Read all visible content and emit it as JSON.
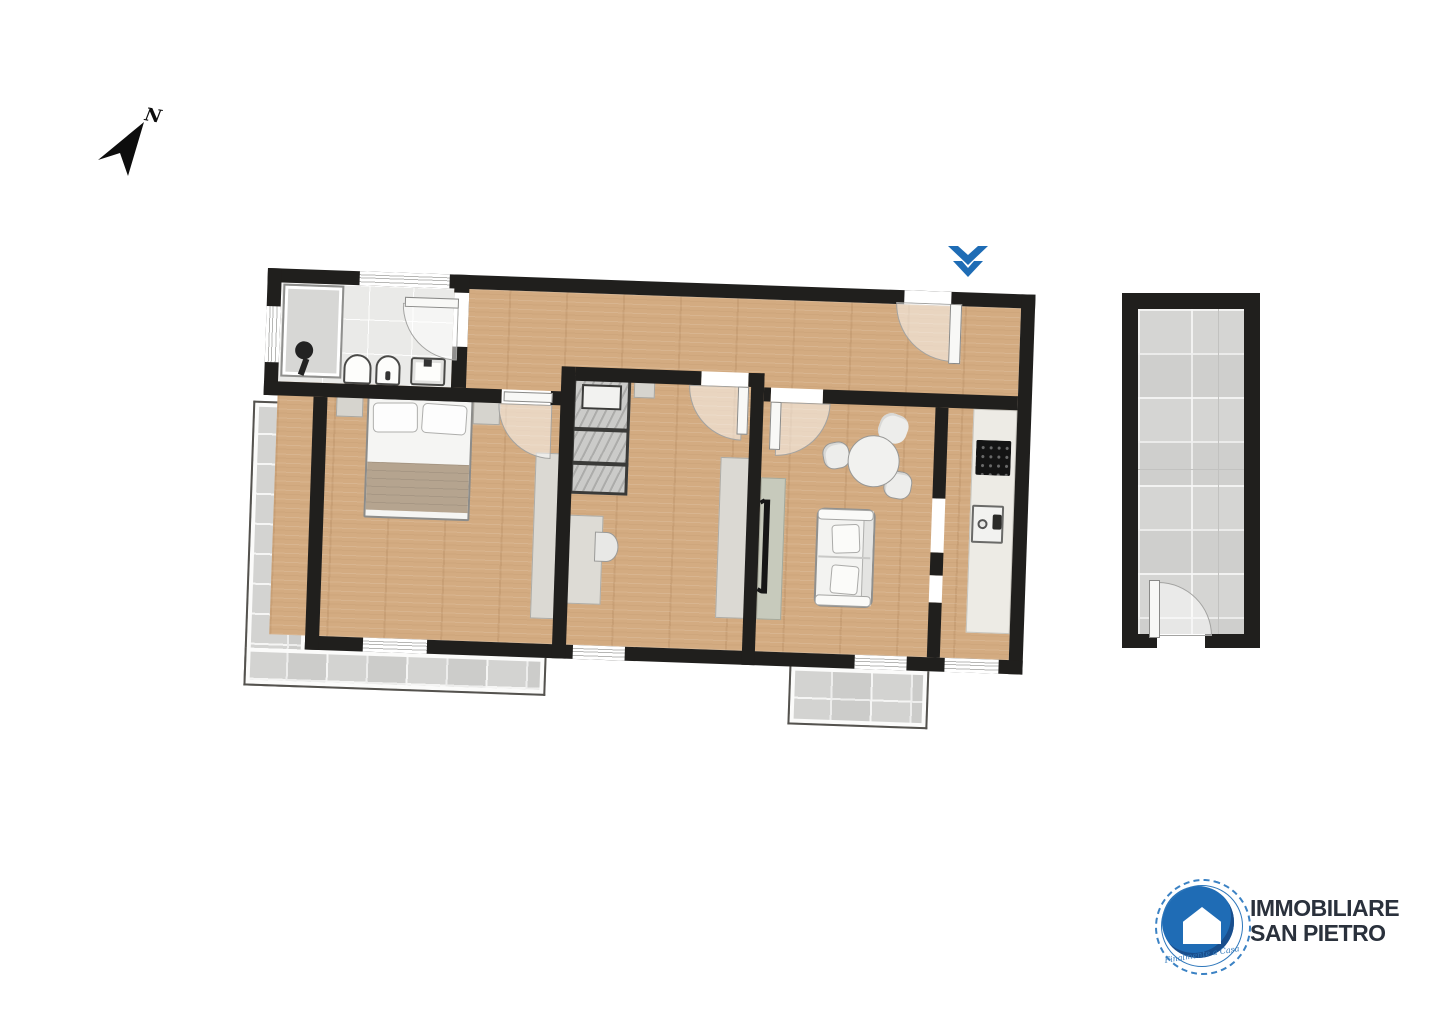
{
  "page": {
    "background": "#ffffff"
  },
  "compass": {
    "label": "N",
    "icon": "north-arrow-icon"
  },
  "entrance_marker": {
    "icon": "double-chevron-down-icon",
    "color": "#1e6cb5"
  },
  "palette": {
    "wall": "#201f1d",
    "wood_floor": "#d3ab81",
    "bath_floor": "#eaeae8",
    "tile_floor": "#d8d8d6",
    "counter": "#edebe5",
    "cabinet_green": "#c7cabc",
    "furniture_gray": "#d6d4ce",
    "accent_blue": "#1e6cb5",
    "logo_text": "#2a313c"
  },
  "logo": {
    "line1": "IMMOBILIARE",
    "line2": "SAN PIETRO",
    "tagline": "Finalmente a Casa",
    "icon": "house-circle-icon"
  },
  "floor_plan": {
    "orientation_deg": 2,
    "rooms": [
      {
        "name": "bathroom",
        "floor": "gray-stone",
        "items": [
          "shower",
          "toilet",
          "bidet",
          "washbasin",
          "door",
          "window"
        ]
      },
      {
        "name": "hallway",
        "floor": "wood",
        "items": [
          "entrance-door",
          "window"
        ]
      },
      {
        "name": "bedroom",
        "floor": "wood",
        "items": [
          "double-bed",
          "nightstand-left",
          "nightstand-right",
          "wardrobe",
          "door",
          "window"
        ]
      },
      {
        "name": "bedroom-2",
        "floor": "wood",
        "items": [
          "single-bed",
          "nightstand",
          "desk",
          "chair",
          "wardrobe",
          "door",
          "window"
        ]
      },
      {
        "name": "living-room",
        "floor": "wood",
        "items": [
          "round-table",
          "chair",
          "chair",
          "chair",
          "sofa",
          "tv-cabinet",
          "tv",
          "door"
        ]
      },
      {
        "name": "kitchen",
        "floor": "wood",
        "items": [
          "counter",
          "cooktop",
          "sink",
          "pass-through",
          "window"
        ]
      },
      {
        "name": "terrace",
        "floor": "tile",
        "items": []
      },
      {
        "name": "balcony",
        "floor": "tile",
        "items": []
      },
      {
        "name": "annex-room",
        "floor": "tile",
        "items": [
          "door"
        ]
      }
    ]
  }
}
